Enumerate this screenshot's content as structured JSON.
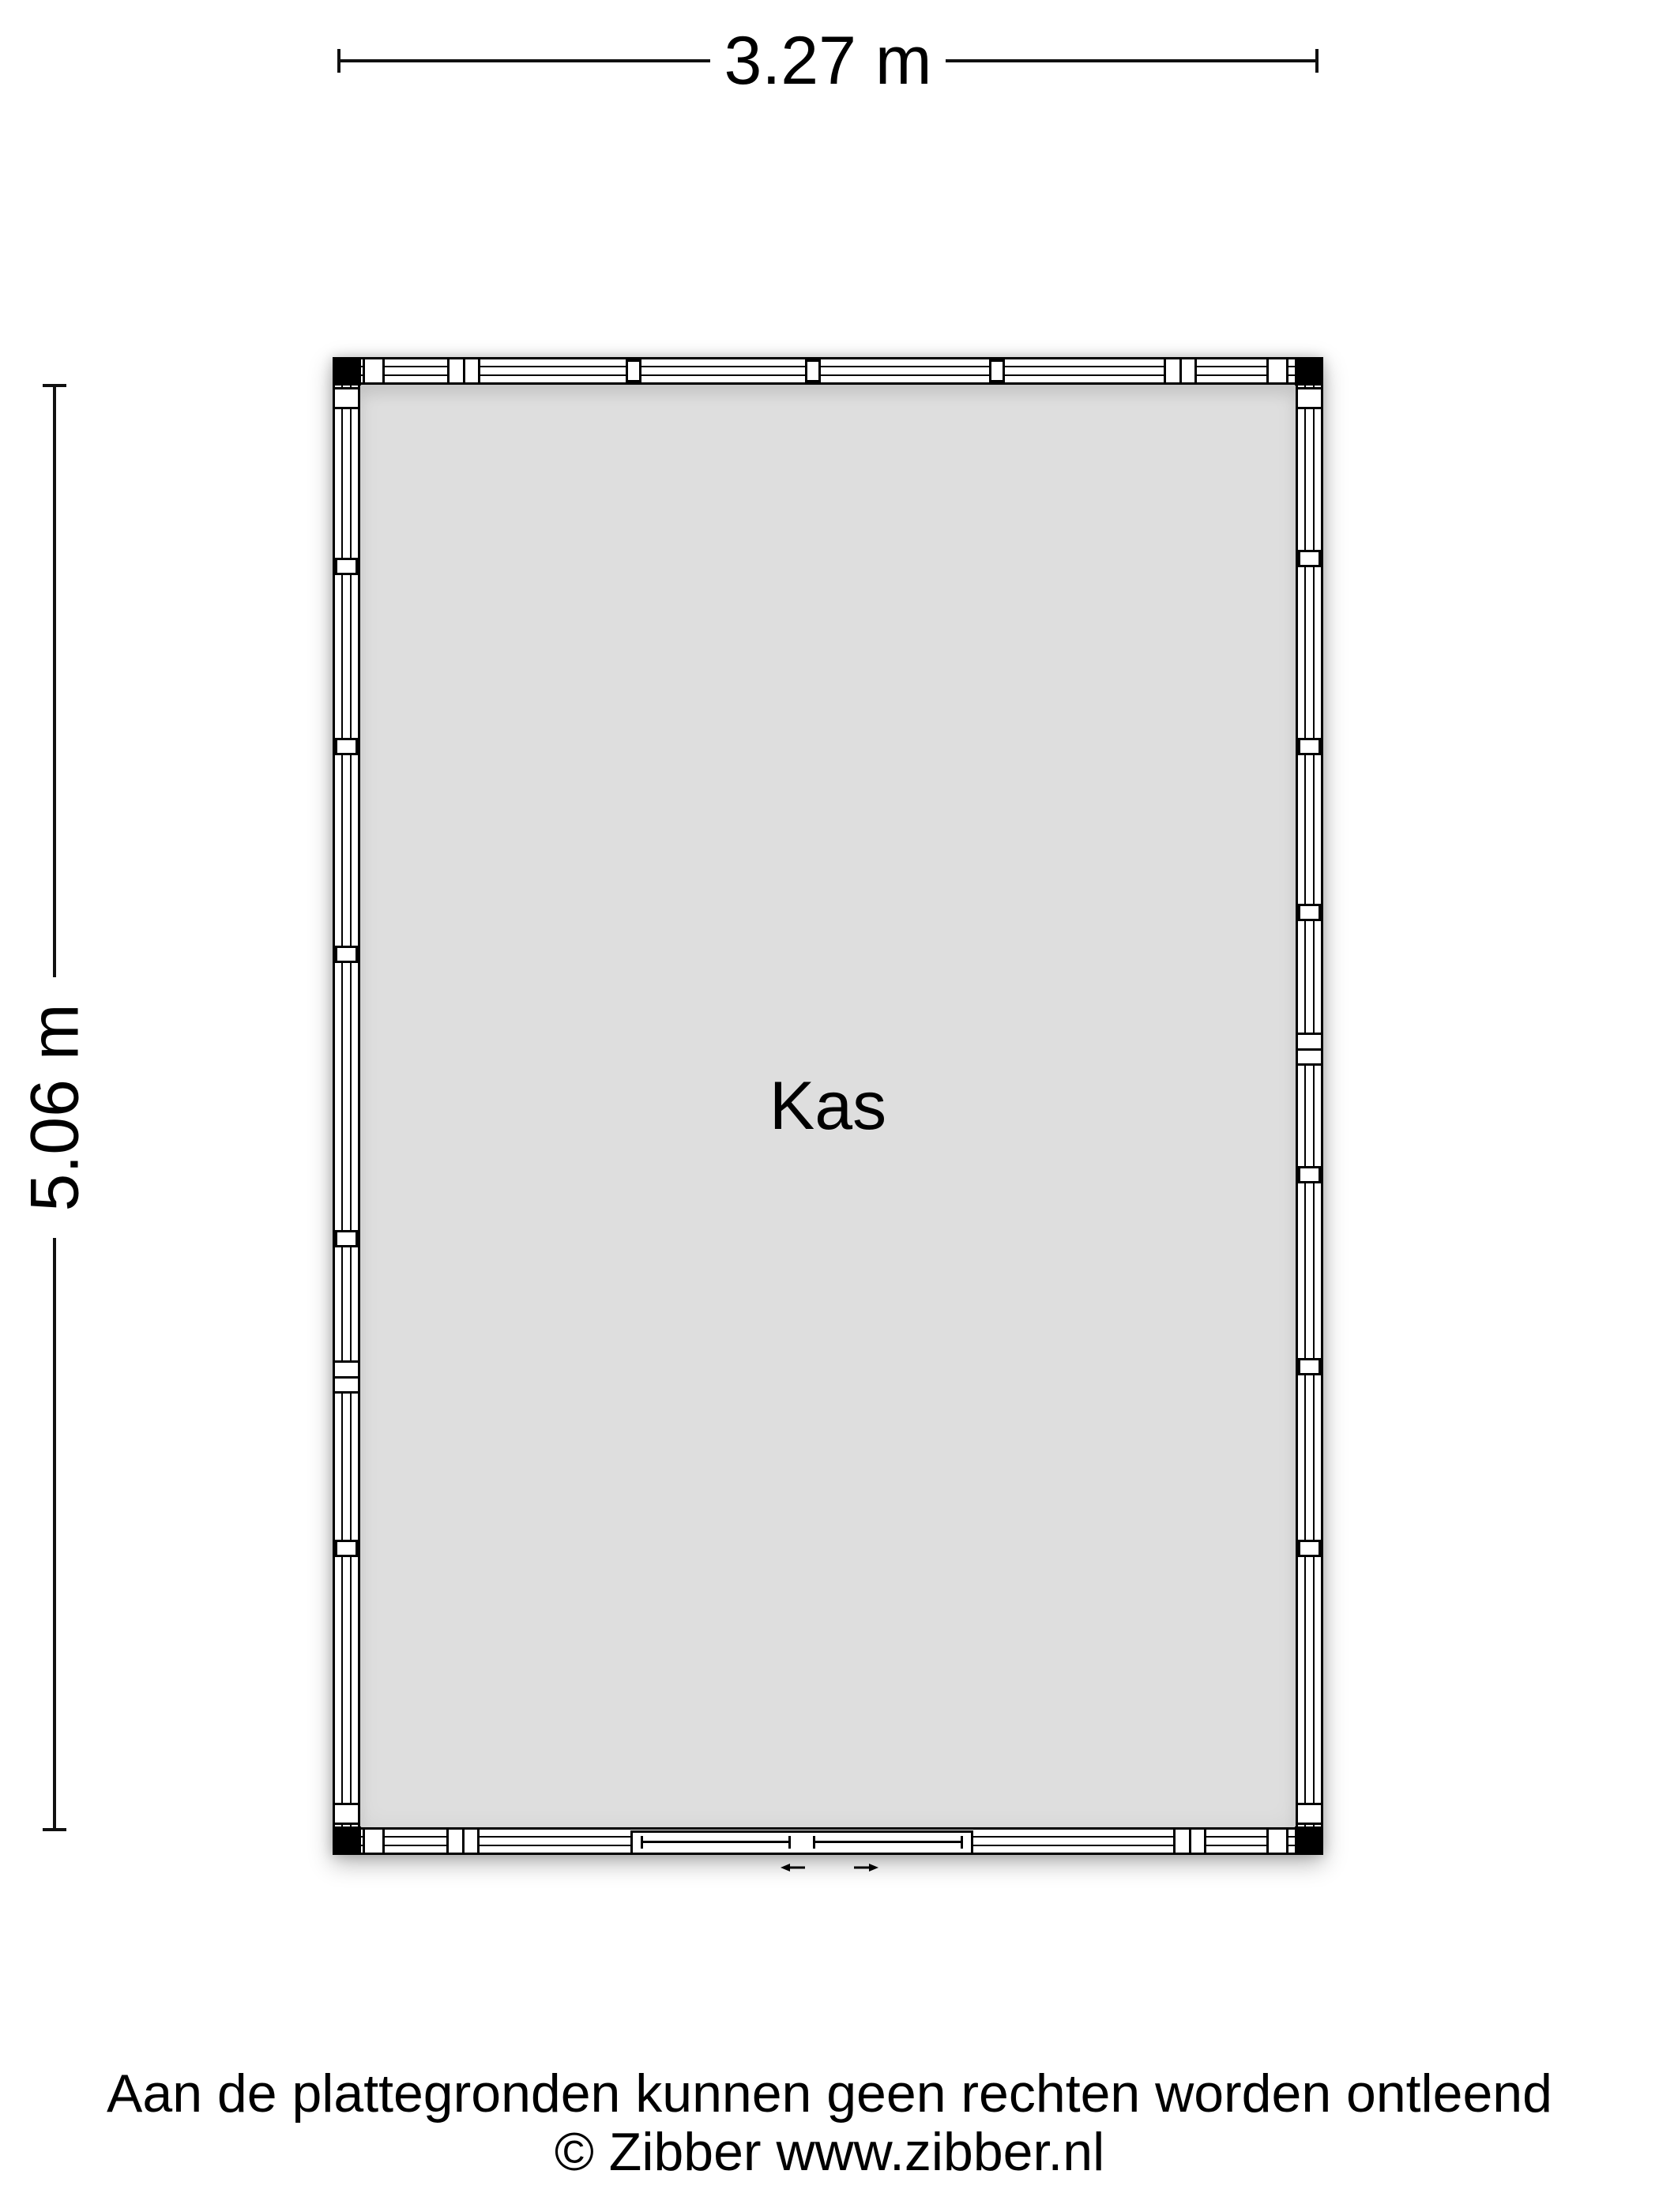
{
  "floor_plan": {
    "room_label": "Kas",
    "dimension_width_label": "3.27 m",
    "dimension_height_label": "5.06 m",
    "door_type": "sliding-door"
  },
  "footer": {
    "disclaimer": "Aan de plattegronden kunnen geen rechten worden ontleend",
    "copyright": "© Zibber www.zibber.nl"
  },
  "colors": {
    "background": "#ffffff",
    "floor": "#dedede",
    "wall_outline": "#000000",
    "corner_post": "#000000",
    "text": "#000000"
  },
  "icons": {
    "slide_left": "slide-direction-left-icon",
    "slide_right": "slide-direction-right-icon"
  }
}
